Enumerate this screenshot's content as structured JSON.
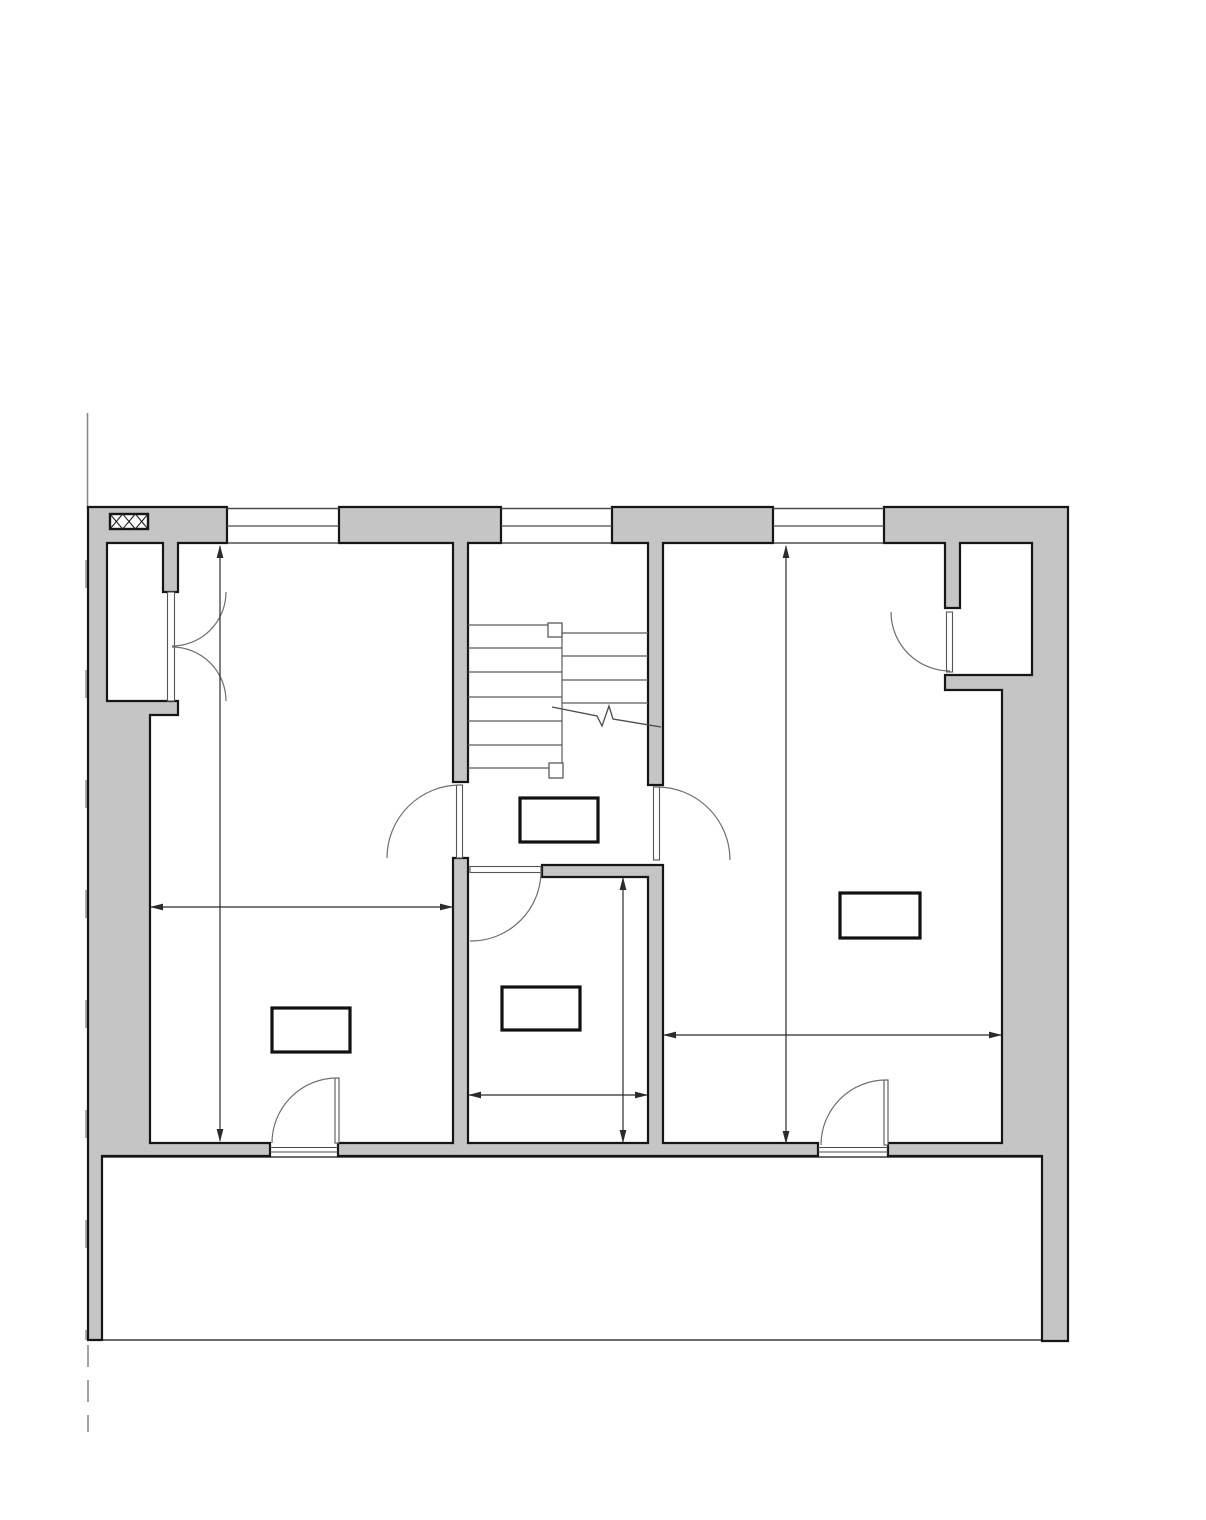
{
  "document": {
    "type": "architectural-floor-plan",
    "canvas": {
      "width": 1206,
      "height": 1520
    },
    "visible_text": []
  },
  "colors": {
    "background": "#ffffff",
    "wall_fill": "#c5c5c5",
    "outline": "#161616",
    "thin_line": "#4a4a4a",
    "stair_line": "#5a5a5a",
    "door_line": "#6e6e6e",
    "dim_line": "#2b2b2b",
    "property_line": "#8a8a8a",
    "label_border": "#111111"
  },
  "plan": {
    "walls": [
      {
        "name": "wall-left-complex",
        "d": "M88,507 H227 V543 H178 V592 H163 V543 H107 V701 H178 V715 H150 V1143 H270 V1156 H102 V1340 H88 Z"
      },
      {
        "name": "wall-center-room",
        "d": "M453,858 H468 V1143 H648 V877 H542 V865 H663 V1143 H818 V1156 H338 V1143 H453 Z"
      },
      {
        "name": "wall-right-complex",
        "d": "M884,507 H1068 V1341 H1042 V1156 H888 V1143 H1002 V690 H945 V675 H1032 V543 H960 V608 H945 V543 H884 Z"
      },
      {
        "name": "wall-pier-stair-left",
        "d": "M339,507 H501 V543 H468 V782 H453 V543 H339 Z"
      },
      {
        "name": "wall-pier-stair-right",
        "d": "M612,507 H773 V543 H663 V785 H648 V543 H612 Z"
      }
    ],
    "windows": [
      {
        "name": "window-top-1",
        "x1": 227,
        "x2": 339,
        "lines_y": [
          508.5,
          526,
          543
        ]
      },
      {
        "name": "window-top-2",
        "x1": 501,
        "x2": 612,
        "lines_y": [
          508.5,
          526,
          543
        ]
      },
      {
        "name": "window-top-3",
        "x1": 773,
        "x2": 884,
        "lines_y": [
          508.5,
          526,
          543
        ]
      }
    ],
    "stairs": {
      "left_flight_treads": {
        "x1": 468,
        "x2": 562,
        "ys": [
          625,
          648,
          672,
          697,
          721,
          745,
          768
        ]
      },
      "right_flight_treads": {
        "x1": 562,
        "x2": 648,
        "ys": [
          633,
          656,
          680,
          703
        ]
      },
      "center_rail": {
        "x": 562,
        "y1": 625,
        "y2": 778
      },
      "newel_posts": [
        {
          "x": 548,
          "y": 623,
          "w": 14,
          "h": 14
        },
        {
          "x": 549,
          "y": 763,
          "w": 14,
          "h": 15
        }
      ],
      "break_line_points": "552,707 597,716 602,726 609,706 613,719 661,727"
    },
    "doors": {
      "arcs": [
        {
          "name": "double-door-left-closet-top",
          "d": "M226,592 A54,54 0 0 1 172,646"
        },
        {
          "name": "double-door-left-closet-bottom",
          "d": "M226,701 A54,54 0 0 0 172,647"
        },
        {
          "name": "door-hall-to-left-room",
          "d": "M460,785 A73,73 0 0 0 387,858"
        },
        {
          "name": "door-hall-to-right-room",
          "d": "M657,787 A73,73 0 0 1 730,860"
        },
        {
          "name": "door-center-room",
          "d": "M541,871 A70,70 0 0 1 470,941"
        },
        {
          "name": "door-left-room-south",
          "d": "M337,1078 A65,65 0 0 0 272,1143"
        },
        {
          "name": "door-right-room-south",
          "d": "M886,1080 A65,65 0 0 0 821,1145"
        },
        {
          "name": "door-right-closet",
          "d": "M891,612 A59,59 0 0 0 950,671"
        }
      ],
      "leaves": [
        {
          "name": "leaf-double-door-left-closet",
          "x": 167.5,
          "y": 592,
          "w": 7,
          "h": 109
        },
        {
          "name": "leaf-hall-left",
          "x": 456.5,
          "y": 785,
          "w": 6,
          "h": 73
        },
        {
          "name": "leaf-hall-right",
          "x": 653.5,
          "y": 787,
          "w": 6,
          "h": 73
        },
        {
          "name": "leaf-center-room",
          "x": 470,
          "y": 866.5,
          "w": 71,
          "h": 6
        },
        {
          "name": "leaf-left-room-south",
          "x": 335,
          "y": 1078,
          "w": 4,
          "h": 65
        },
        {
          "name": "leaf-right-room-south",
          "x": 884,
          "y": 1080,
          "w": 4,
          "h": 65
        },
        {
          "name": "leaf-right-closet",
          "x": 946.5,
          "y": 612,
          "w": 6,
          "h": 60
        }
      ],
      "thresholds": [
        {
          "x1": 270,
          "x2": 338,
          "y": 1147.5
        },
        {
          "x1": 270,
          "x2": 338,
          "y": 1152
        },
        {
          "x1": 818,
          "x2": 888,
          "y": 1147.5
        },
        {
          "x1": 818,
          "x2": 888,
          "y": 1152
        }
      ]
    },
    "label_boxes": [
      {
        "name": "label-box-hall",
        "x": 520,
        "y": 798,
        "w": 78,
        "h": 44
      },
      {
        "name": "label-box-left-room",
        "x": 272,
        "y": 1008,
        "w": 78,
        "h": 44
      },
      {
        "name": "label-box-center-room",
        "x": 502,
        "y": 987,
        "w": 78,
        "h": 43
      },
      {
        "name": "label-box-right-room",
        "x": 840,
        "y": 893,
        "w": 80,
        "h": 45
      }
    ],
    "dimensions": {
      "lines": [
        {
          "x1": 220,
          "y1": 546,
          "x2": 220,
          "y2": 1141
        },
        {
          "x1": 151,
          "y1": 907,
          "x2": 452,
          "y2": 907
        },
        {
          "x1": 786,
          "y1": 546,
          "x2": 786,
          "y2": 1143
        },
        {
          "x1": 664,
          "y1": 1035,
          "x2": 1001,
          "y2": 1035
        },
        {
          "x1": 623,
          "y1": 878,
          "x2": 623,
          "y2": 1142
        },
        {
          "x1": 469,
          "y1": 1095,
          "x2": 647,
          "y2": 1095
        }
      ],
      "arrows": [
        {
          "x": 220,
          "y": 545,
          "dir": "up"
        },
        {
          "x": 220,
          "y": 1142,
          "dir": "down"
        },
        {
          "x": 150,
          "y": 907,
          "dir": "left"
        },
        {
          "x": 453,
          "y": 907,
          "dir": "right"
        },
        {
          "x": 786,
          "y": 545,
          "dir": "up"
        },
        {
          "x": 786,
          "y": 1144,
          "dir": "down"
        },
        {
          "x": 663,
          "y": 1035,
          "dir": "left"
        },
        {
          "x": 1002,
          "y": 1035,
          "dir": "right"
        },
        {
          "x": 623,
          "y": 877,
          "dir": "up"
        },
        {
          "x": 623,
          "y": 1143,
          "dir": "down"
        },
        {
          "x": 468,
          "y": 1095,
          "dir": "left"
        },
        {
          "x": 648,
          "y": 1095,
          "dir": "right"
        }
      ]
    },
    "terrace": {
      "top_edge": {
        "x1": 102,
        "x2": 1042,
        "y": 1157
      },
      "bottom_edge": {
        "x1": 88,
        "x2": 1042,
        "y": 1340
      }
    },
    "property_line": {
      "x": 87.5,
      "solid_top": {
        "y1": 413,
        "y2": 509
      },
      "dashed_mid": {
        "y1": 560,
        "y2": 1340,
        "dash": "28 82"
      },
      "dashed_bottom": {
        "y1": 1345,
        "y2": 1432,
        "dash": "22 13"
      }
    },
    "chimney_hatch": {
      "x": 110,
      "y": 514,
      "w": 38,
      "h": 15,
      "cells": 3
    }
  }
}
